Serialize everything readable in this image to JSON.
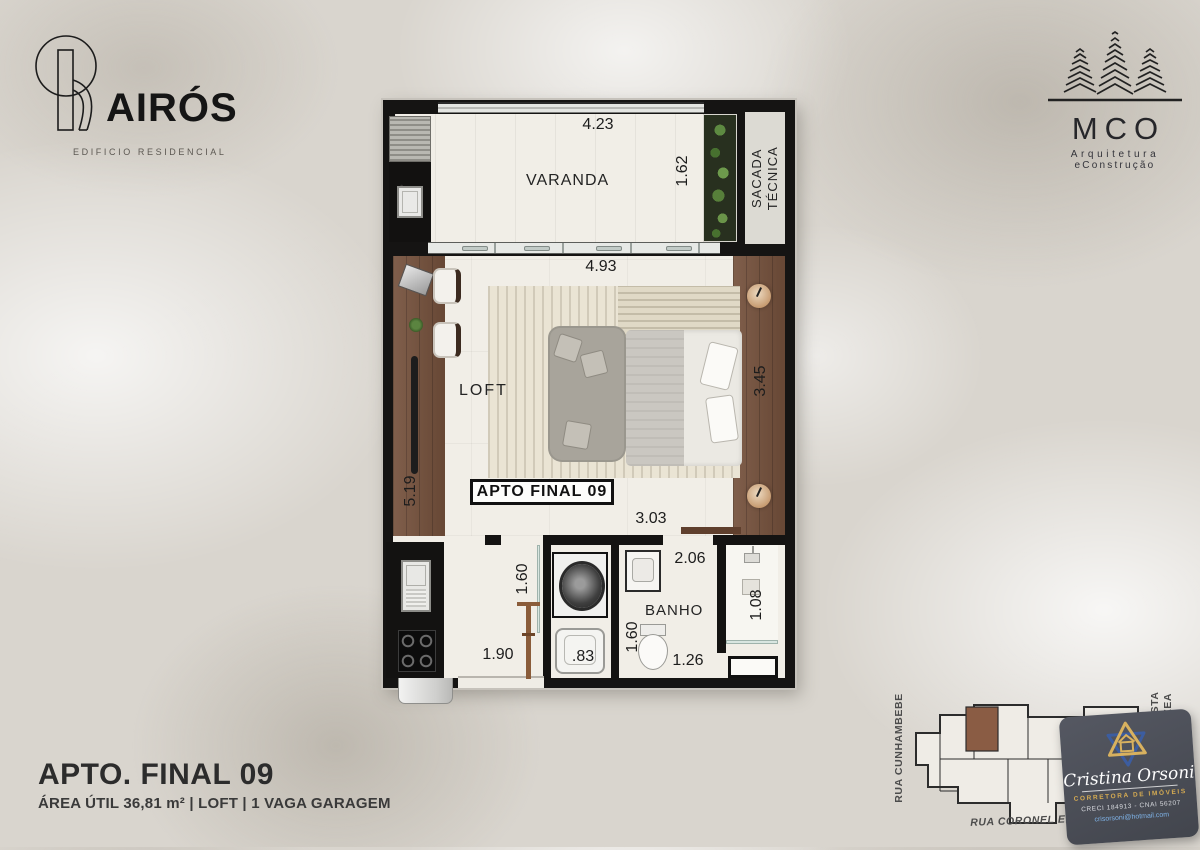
{
  "header": {
    "building": {
      "name": "AIRÓS",
      "subtitle": "EDIFICIO RESIDENCIAL"
    },
    "architect": {
      "name": "MCO",
      "line1": "Arquitetura",
      "line2": "eConstrução"
    }
  },
  "plan": {
    "unit_label": "APTO FINAL 09",
    "rooms": {
      "varanda": "VARANDA",
      "sacada_line1": "SACADA",
      "sacada_line2": "TÉCNICA",
      "loft": "LOFT",
      "banho": "BANHO"
    },
    "dims": {
      "varanda_width": "4.23",
      "varanda_depth": "1.62",
      "loft_width": "4.93",
      "loft_depth": "3.45",
      "left_wall": "5.19",
      "hall_width": "3.03",
      "laundry_depth": "1.60",
      "banho_width_top": "2.06",
      "banho_depth": "1.60",
      "banho_width_bottom": "1.26",
      "shower_depth": "1.08",
      "entry_width": "1.90",
      "laundry_width": ".83"
    }
  },
  "title_block": {
    "title": "APTO. FINAL 09",
    "subtitle": "ÁREA ÚTIL 36,81 m² | LOFT | 1 VAGA GARAGEM"
  },
  "site_plan": {
    "street_left": "RUA CUNHAMBEBE",
    "street_right_line1": "RUA MARANHISTA",
    "street_right_line2": "VIRGILIO VARZEA",
    "street_bottom": "RUA CORONEL ERNESTO DE OLIVEIRA"
  },
  "realtor_badge": {
    "name": "Cristina Orsoni",
    "role": "CORRETORA DE IMÓVEIS",
    "credentials": "CRECI 184913 - CNAI 56207",
    "email": "crisorsoni@hotmail.com"
  },
  "colors": {
    "background": "#d9d5ce",
    "wall": "#141312",
    "floor": "#f1eee7",
    "wood": "#75513c",
    "highlight_unit": "#8a5c44",
    "badge_bg": "#4a4d56",
    "badge_gold": "#d5ab52",
    "badge_blue": "#7fb3e8"
  }
}
